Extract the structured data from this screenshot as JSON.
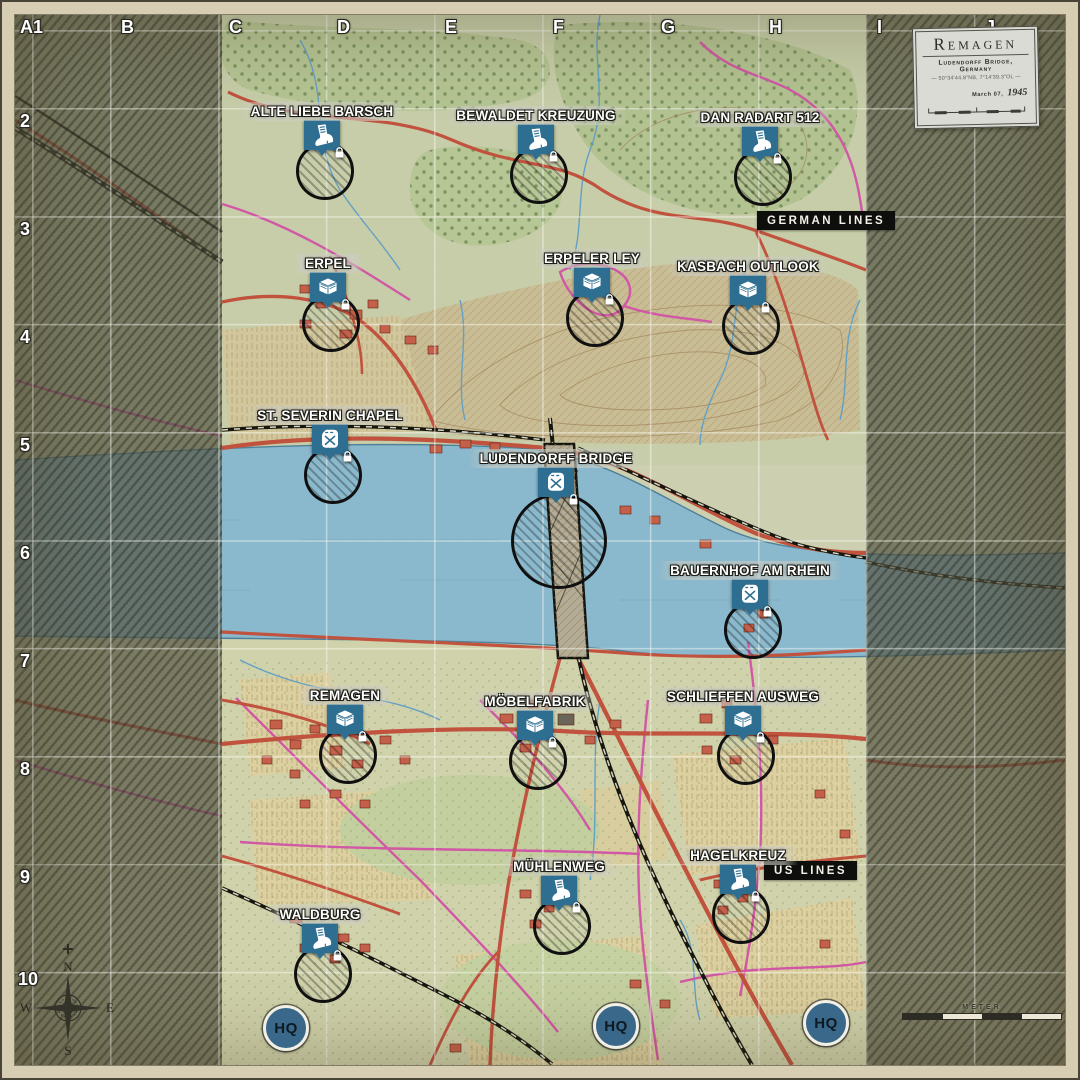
{
  "title_card": {
    "title": "Remagen",
    "subtitle": "Ludendorff Bridge, Germany",
    "coordinates": "— 50°34'44.8\"NB, 7°14'39.3\"OL —",
    "date_prefix": "March 07,",
    "date_year": "1945"
  },
  "grid": {
    "columns": [
      "A1",
      "B",
      "C",
      "D",
      "E",
      "F",
      "G",
      "H",
      "I",
      "J"
    ],
    "rows": [
      "2",
      "3",
      "4",
      "5",
      "6",
      "7",
      "8",
      "9",
      "10"
    ]
  },
  "front_lines": {
    "german": "GERMAN LINES",
    "us": "US LINES"
  },
  "hq_label": "HQ",
  "compass": {
    "north": "N",
    "east": "E",
    "south": "S",
    "west": "W"
  },
  "scale_bar": {
    "label": "METER"
  },
  "markers": [
    {
      "label": "ALTE LIEBE BARSCH",
      "icon": "infantry-boot",
      "badge": "lock",
      "grid_cell": "D2"
    },
    {
      "label": "BEWALDET KREUZUNG",
      "icon": "infantry-boot",
      "badge": "lock",
      "grid_cell": "F2"
    },
    {
      "label": "DAN RADART 512",
      "icon": "infantry-boot",
      "badge": "lock",
      "grid_cell": "H2"
    },
    {
      "label": "ERPEL",
      "icon": "supply-crate",
      "badge": "lock",
      "grid_cell": "D3"
    },
    {
      "label": "ERPELER LEY",
      "icon": "supply-crate",
      "badge": "lock",
      "grid_cell": "F3"
    },
    {
      "label": "KASBACH OUTLOOK",
      "icon": "supply-crate",
      "badge": "lock",
      "grid_cell": "H3"
    },
    {
      "label": "ST. SEVERIN CHAPEL",
      "icon": "fuel-can",
      "badge": "lock",
      "grid_cell": "D5"
    },
    {
      "label": "LUDENDORFF BRIDGE",
      "icon": "fuel-can",
      "badge": "lock",
      "grid_cell": "F5"
    },
    {
      "label": "BAUERNHOF AM RHEIN",
      "icon": "fuel-can",
      "badge": "lock",
      "grid_cell": "H6"
    },
    {
      "label": "REMAGEN",
      "icon": "supply-crate",
      "badge": "lock",
      "grid_cell": "D7"
    },
    {
      "label": "MÖBELFABRIK",
      "icon": "supply-crate",
      "badge": "lock",
      "grid_cell": "F7"
    },
    {
      "label": "SCHLIEFFEN AUSWEG",
      "icon": "supply-crate",
      "badge": "lock",
      "grid_cell": "H7"
    },
    {
      "label": "MÜHLENWEG",
      "icon": "infantry-boot",
      "badge": "lock",
      "grid_cell": "F9"
    },
    {
      "label": "HAGELKREUZ",
      "icon": "infantry-boot",
      "badge": "lock",
      "grid_cell": "H9"
    },
    {
      "label": "WALDBURG",
      "icon": "infantry-boot",
      "badge": "lock",
      "grid_cell": "D9"
    }
  ],
  "colors": {
    "marker_blue": "#2e6e91",
    "hq_blue": "#39688a",
    "river_blue": "#8ab8cc",
    "road_red": "#c0523e",
    "road_pink": "#d158a5",
    "oob_olive": "#545442",
    "banner_black": "#0e0e0c",
    "paper": "#ccd0b0"
  }
}
